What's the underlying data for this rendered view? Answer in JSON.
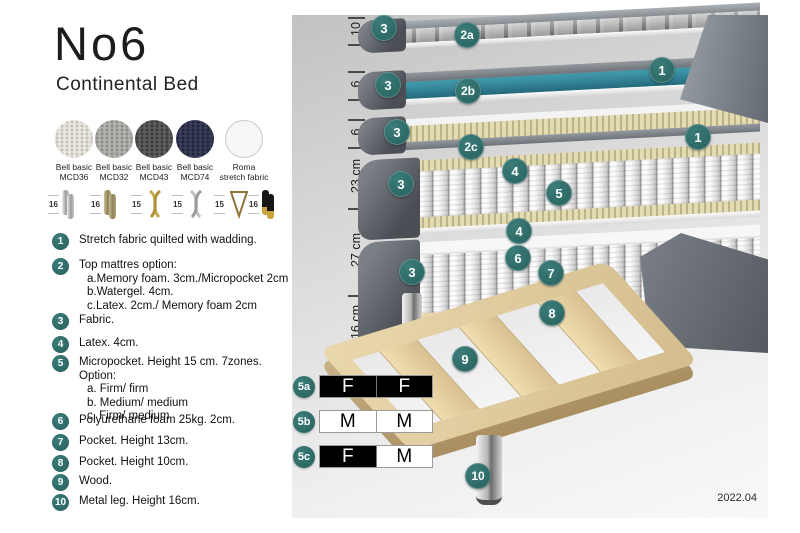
{
  "title": {
    "name": "No6",
    "subtitle": "Continental Bed"
  },
  "swatches": [
    {
      "line1": "Bell basic",
      "line2": "MCD36"
    },
    {
      "line1": "Bell basic",
      "line2": "MCD32"
    },
    {
      "line1": "Bell basic",
      "line2": "MCD43"
    },
    {
      "line1": "Bell basic",
      "line2": "MCD74"
    },
    {
      "line1": "Roma",
      "line2": "stretch fabric"
    }
  ],
  "legs": [
    {
      "size": "16",
      "type": "chrome-cylinder-leg"
    },
    {
      "size": "16",
      "type": "wood-cylinder-leg"
    },
    {
      "size": "15",
      "type": "gold-twisted-leg"
    },
    {
      "size": "15",
      "type": "silver-twisted-leg"
    },
    {
      "size": "15",
      "type": "hairpin-leg"
    },
    {
      "size": "16",
      "type": "black-gold-leg"
    }
  ],
  "legend": {
    "items": [
      {
        "num": "1",
        "text": "Stretch fabric quilted with wadding."
      },
      {
        "num": "2",
        "text": "Top mattres option:",
        "sub": [
          "a.Memory foam. 3cm./Micropocket 2cm",
          "b.Watergel. 4cm.",
          "c.Latex. 2cm./ Memory foam 2cm"
        ]
      },
      {
        "num": "3",
        "text": "Fabric."
      },
      {
        "num": "4",
        "text": "Latex. 4cm."
      },
      {
        "num": "5",
        "text": "Micropocket. Height 15 cm. 7zones. Option:",
        "sub": [
          "a. Firm/ firm",
          "b. Medium/ medium",
          "c. Firm/ medium"
        ]
      },
      {
        "num": "6",
        "text": "Polyurethane foam 25kg. 2cm."
      },
      {
        "num": "7",
        "text": "Pocket. Height 13cm."
      },
      {
        "num": "8",
        "text": "Pocket. Height 10cm."
      },
      {
        "num": "9",
        "text": "Wood."
      },
      {
        "num": "10",
        "text": "Metal leg. Height 16cm."
      }
    ]
  },
  "diagram": {
    "measurements": [
      "10",
      "6",
      "6",
      "23 cm",
      "27 cm",
      "16 cm"
    ],
    "badges": [
      {
        "label": "3",
        "x": 92,
        "y": 13
      },
      {
        "label": "2a",
        "x": 175,
        "y": 20
      },
      {
        "label": "1",
        "x": 370,
        "y": 55
      },
      {
        "label": "3",
        "x": 96,
        "y": 70
      },
      {
        "label": "2b",
        "x": 176,
        "y": 76
      },
      {
        "label": "1",
        "x": 406,
        "y": 122
      },
      {
        "label": "3",
        "x": 105,
        "y": 117
      },
      {
        "label": "2c",
        "x": 179,
        "y": 132
      },
      {
        "label": "3",
        "x": 109,
        "y": 169
      },
      {
        "label": "4",
        "x": 223,
        "y": 156
      },
      {
        "label": "5",
        "x": 267,
        "y": 178
      },
      {
        "label": "4",
        "x": 227,
        "y": 216
      },
      {
        "label": "3",
        "x": 120,
        "y": 257
      },
      {
        "label": "6",
        "x": 226,
        "y": 243
      },
      {
        "label": "7",
        "x": 259,
        "y": 258
      },
      {
        "label": "8",
        "x": 260,
        "y": 298
      },
      {
        "label": "9",
        "x": 173,
        "y": 344
      },
      {
        "label": "10",
        "x": 186,
        "y": 461
      }
    ],
    "firmness_table": [
      {
        "badge": "5a",
        "cells": [
          {
            "text": "F",
            "fill": "black"
          },
          {
            "text": "F",
            "fill": "black"
          }
        ]
      },
      {
        "badge": "5b",
        "cells": [
          {
            "text": "M",
            "fill": "white"
          },
          {
            "text": "M",
            "fill": "white"
          }
        ]
      },
      {
        "badge": "5c",
        "cells": [
          {
            "text": "F",
            "fill": "black"
          },
          {
            "text": "M",
            "fill": "white"
          }
        ]
      }
    ],
    "version": "2022.04",
    "colors": {
      "badge_teal": "#2d6e6b",
      "watergel_teal": "#2e7c8e",
      "latex_cream": "#d9d2a6",
      "wood": "#dcc49c",
      "cover_gray": "#555a61"
    }
  }
}
